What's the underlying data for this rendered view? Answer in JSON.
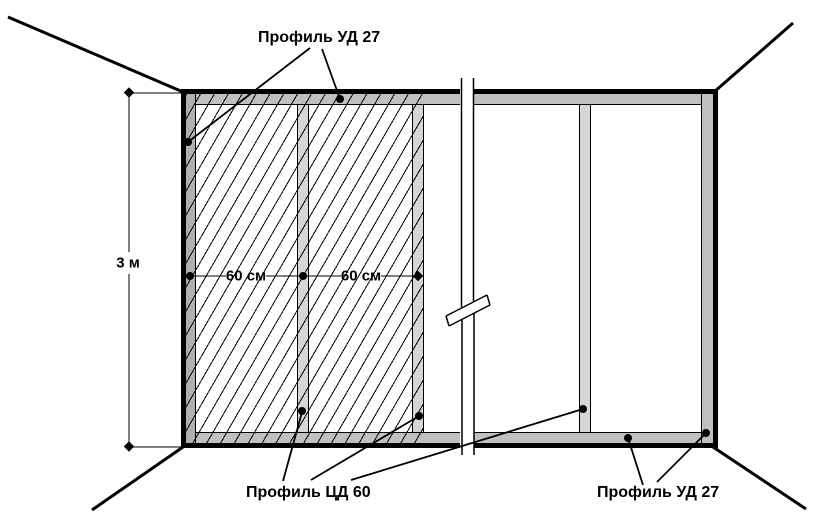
{
  "diagram": {
    "type": "suspended-ceiling-frame-scheme",
    "labels": {
      "profile_ud_top": "Профиль УД 27",
      "profile_cd_bottom": "Профиль ЦД 60",
      "profile_ud_bottom_right": "Профиль УД 27"
    },
    "dimensions": {
      "room_width": "3 м",
      "cd_spacing_1": "60 см",
      "cd_spacing_2": "60 см"
    },
    "colors": {
      "ud_band": "#c0c0c0",
      "ud_band_left": "#b0b0b0",
      "cd_strip": "#d6d6d6",
      "line": "#000000",
      "background": "#ffffff"
    }
  }
}
